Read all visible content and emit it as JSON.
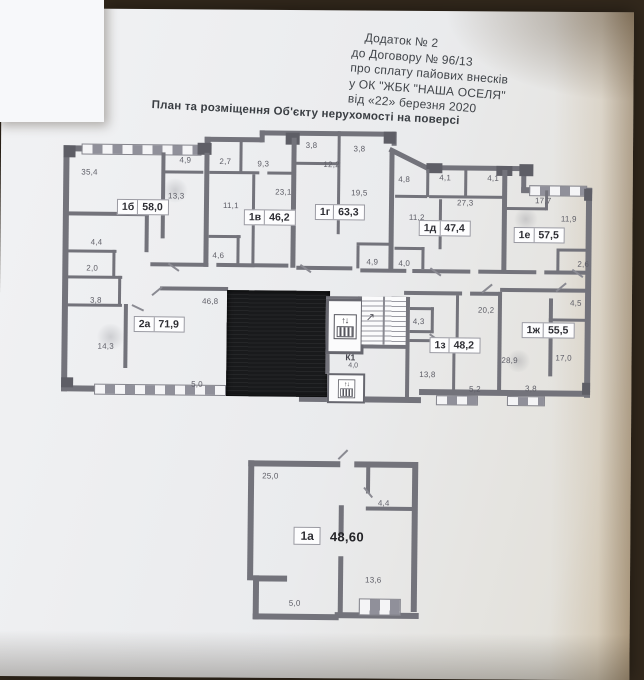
{
  "colors": {
    "background": "#32281c",
    "paper": "#eef0f2",
    "wall": "#73737b",
    "redacted_block": "#191a1c"
  },
  "header": {
    "lines": [
      "Додаток № 2",
      "до Договору № 96/13",
      "про сплату пайових внесків",
      "у ОК \"ЖБК \"НАША ОСЕЛЯ\"",
      "від «22» березня 2020"
    ]
  },
  "plan_title": "План та розміщення Об'єкту нерухомості на поверсі",
  "floor_plan": {
    "apartments": [
      {
        "id": "1б",
        "area": "58,0",
        "rooms": [
          "35,4",
          "13,3",
          "4,9",
          "4,4"
        ]
      },
      {
        "id": "1в",
        "area": "46,2",
        "rooms": [
          "2,7",
          "9,3",
          "11,1",
          "23,1",
          "4,6"
        ]
      },
      {
        "id": "1г",
        "area": "63,3",
        "rooms": [
          "3,8",
          "3,8",
          "12,2",
          "19,5",
          "4,9"
        ]
      },
      {
        "id": "1д",
        "area": "47,4",
        "rooms": [
          "4,8",
          "4,1",
          "4,1",
          "11,2",
          "27,3",
          "4,0"
        ]
      },
      {
        "id": "1е",
        "area": "57,5",
        "rooms": [
          "17,7",
          "11,9",
          "2,6"
        ]
      },
      {
        "id": "2а",
        "area": "71,9",
        "rooms": [
          "2,0",
          "3,8",
          "14,3",
          "46,8",
          "5,0"
        ]
      },
      {
        "id": "1з",
        "area": "48,2",
        "rooms": [
          "20,2",
          "4,3",
          "13,8",
          "5,2"
        ]
      },
      {
        "id": "1ж",
        "area": "55,5",
        "rooms": [
          "4,5",
          "17,0",
          "28,9",
          "3,8"
        ]
      }
    ],
    "core": {
      "label": "К1",
      "area": "4,0",
      "icons": [
        "elevator-icon",
        "elevator-icon",
        "staircase"
      ]
    }
  },
  "unit_plan": {
    "id": "1а",
    "area": "48,60",
    "rooms": [
      "25,0",
      "4,4",
      "13,6",
      "5,0"
    ]
  }
}
